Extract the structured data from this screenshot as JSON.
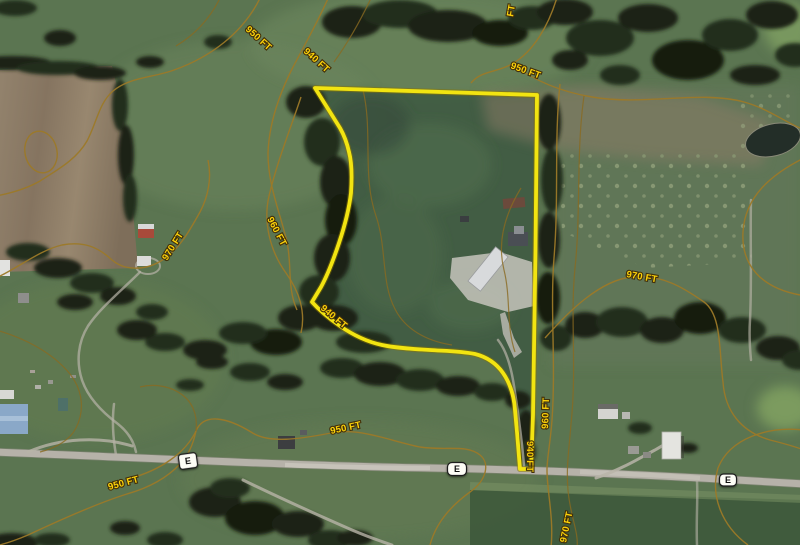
{
  "map": {
    "kind": "satellite imagery with elevation contour overlay and parcel outline",
    "elevation_unit": "FT",
    "contour_elevations": [
      "940 FT",
      "950 FT",
      "960 FT",
      "970 FT"
    ],
    "parcel_outline_color": "#f2e411",
    "contour_line_color": "#9c7928",
    "contour_label_color": "#fbd20a",
    "road_color": "#b6b2a9",
    "route_sign_letter": "E"
  },
  "contour_labels": [
    {
      "text": "950 FT"
    },
    {
      "text": "940 FT"
    },
    {
      "text": "950 FT"
    },
    {
      "text": "FT"
    },
    {
      "text": "970 FT"
    },
    {
      "text": "960 FT"
    },
    {
      "text": "940 FT"
    },
    {
      "text": "950 FT"
    },
    {
      "text": "950 FT"
    },
    {
      "text": "940 FT"
    },
    {
      "text": "960 FT"
    },
    {
      "text": "970 FT"
    },
    {
      "text": "970 FT"
    }
  ],
  "route_markers": [
    {
      "label": "E"
    },
    {
      "label": "E"
    },
    {
      "label": "E"
    }
  ]
}
